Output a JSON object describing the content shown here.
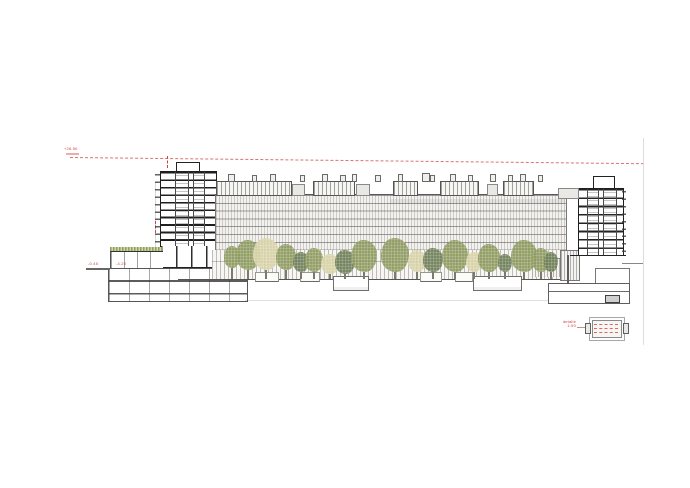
{
  "drawing": {
    "title": "longitudinal-section-elevation",
    "annotations": {
      "limit_line_label": "+28.50",
      "street_level_label": "-0.45",
      "basement_level_label": "-4.20",
      "plaza_level_label": "+0.00",
      "detail_caption_line1": "detalle",
      "detail_caption_line2": "1:50"
    },
    "colors": {
      "accent_red": "#cc4444",
      "ink": "#1f1f1f",
      "facade_gray": "#f3f2ee",
      "tree_olive": "#8e9b60",
      "tree_sage": "#6f7f58",
      "tree_pale": "#d9d3a8",
      "green_roof": "#8fa060"
    },
    "roof_glazed_boxes": [
      {
        "x": 216,
        "w": 74
      },
      {
        "x": 313,
        "w": 40
      },
      {
        "x": 393,
        "w": 23
      },
      {
        "x": 440,
        "w": 37
      },
      {
        "x": 503,
        "w": 29
      }
    ],
    "roof_small_boxes": [
      {
        "x": 292,
        "y": 184,
        "w": 11,
        "h": 10
      },
      {
        "x": 356,
        "y": 184,
        "w": 12,
        "h": 10
      },
      {
        "x": 487,
        "y": 184,
        "w": 9,
        "h": 10
      },
      {
        "x": 558,
        "y": 188,
        "w": 19,
        "h": 9
      }
    ],
    "roof_vents": [
      {
        "x": 228,
        "w": 5,
        "h": 6
      },
      {
        "x": 252,
        "w": 3,
        "h": 5
      },
      {
        "x": 270,
        "w": 4,
        "h": 6
      },
      {
        "x": 300,
        "w": 3,
        "h": 5
      },
      {
        "x": 322,
        "w": 4,
        "h": 6
      },
      {
        "x": 340,
        "w": 4,
        "h": 5
      },
      {
        "x": 352,
        "w": 3,
        "h": 6
      },
      {
        "x": 375,
        "w": 4,
        "h": 5
      },
      {
        "x": 398,
        "w": 3,
        "h": 6
      },
      {
        "x": 422,
        "w": 6,
        "h": 7
      },
      {
        "x": 430,
        "w": 3,
        "h": 5
      },
      {
        "x": 450,
        "w": 4,
        "h": 6
      },
      {
        "x": 468,
        "w": 3,
        "h": 5
      },
      {
        "x": 490,
        "w": 4,
        "h": 6
      },
      {
        "x": 508,
        "w": 3,
        "h": 5
      },
      {
        "x": 520,
        "w": 4,
        "h": 6
      },
      {
        "x": 538,
        "w": 3,
        "h": 5
      }
    ],
    "planters": [
      {
        "x": 255,
        "w": 22
      },
      {
        "x": 300,
        "w": 18
      },
      {
        "x": 420,
        "w": 20
      },
      {
        "x": 455,
        "w": 16
      }
    ],
    "sunken_pits": [
      {
        "x": 333,
        "w": 34
      },
      {
        "x": 473,
        "w": 47
      }
    ],
    "trees": [
      {
        "cx": 232,
        "top": 246,
        "w": 16,
        "h": 22,
        "k": "olive"
      },
      {
        "cx": 248,
        "top": 240,
        "w": 24,
        "h": 30,
        "k": "olive"
      },
      {
        "cx": 266,
        "top": 238,
        "w": 26,
        "h": 32,
        "k": "pale"
      },
      {
        "cx": 286,
        "top": 244,
        "w": 20,
        "h": 26,
        "k": "olive"
      },
      {
        "cx": 301,
        "top": 252,
        "w": 16,
        "h": 20,
        "k": "sage"
      },
      {
        "cx": 314,
        "top": 248,
        "w": 18,
        "h": 24,
        "k": "olive"
      },
      {
        "cx": 330,
        "top": 254,
        "w": 18,
        "h": 20,
        "k": "pale"
      },
      {
        "cx": 345,
        "top": 250,
        "w": 20,
        "h": 24,
        "k": "sage"
      },
      {
        "cx": 364,
        "top": 240,
        "w": 26,
        "h": 32,
        "k": "olive"
      },
      {
        "cx": 395,
        "top": 238,
        "w": 28,
        "h": 34,
        "k": "olive"
      },
      {
        "cx": 417,
        "top": 250,
        "w": 18,
        "h": 22,
        "k": "pale"
      },
      {
        "cx": 433,
        "top": 248,
        "w": 20,
        "h": 24,
        "k": "sage"
      },
      {
        "cx": 455,
        "top": 240,
        "w": 26,
        "h": 32,
        "k": "olive"
      },
      {
        "cx": 474,
        "top": 252,
        "w": 16,
        "h": 20,
        "k": "pale"
      },
      {
        "cx": 489,
        "top": 244,
        "w": 22,
        "h": 28,
        "k": "olive"
      },
      {
        "cx": 505,
        "top": 254,
        "w": 14,
        "h": 18,
        "k": "sage"
      },
      {
        "cx": 524,
        "top": 240,
        "w": 26,
        "h": 32,
        "k": "olive"
      },
      {
        "cx": 541,
        "top": 248,
        "w": 18,
        "h": 24,
        "k": "olive"
      },
      {
        "cx": 551,
        "top": 252,
        "w": 14,
        "h": 20,
        "k": "sage"
      }
    ]
  }
}
